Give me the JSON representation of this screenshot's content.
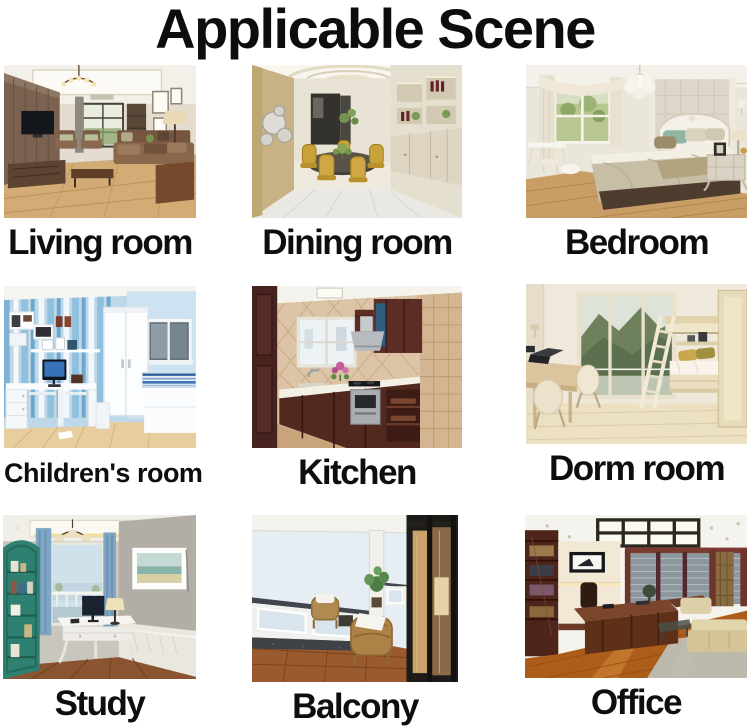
{
  "title": "Applicable Scene",
  "colors": {
    "background": "#ffffff",
    "text": "#0d0d0d"
  },
  "scenes": [
    {
      "id": "living-room",
      "label": "Living room"
    },
    {
      "id": "dining-room",
      "label": "Dining room"
    },
    {
      "id": "bedroom",
      "label": "Bedroom"
    },
    {
      "id": "childrens-room",
      "label": "Children's room"
    },
    {
      "id": "kitchen",
      "label": "Kitchen"
    },
    {
      "id": "dorm-room",
      "label": "Dorm room"
    },
    {
      "id": "study",
      "label": "Study"
    },
    {
      "id": "balcony",
      "label": "Balcony"
    },
    {
      "id": "office",
      "label": "Office"
    }
  ]
}
